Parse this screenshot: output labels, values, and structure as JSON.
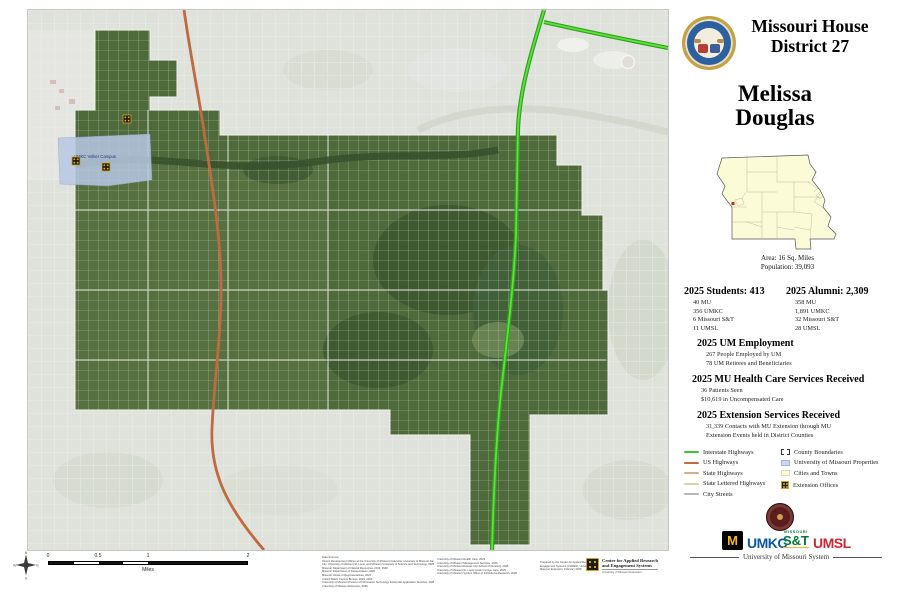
{
  "header": {
    "title_line1": "Missouri House",
    "title_line2": "District 27",
    "name_line1": "Melissa",
    "name_line2": "Douglas"
  },
  "inset": {
    "area": "Area: 16 Sq. Miles",
    "population": "Population: 39,093"
  },
  "stats": {
    "students": {
      "header": "2025 Students: 413",
      "items": [
        "40 MU",
        "356 UMKC",
        "6 Missouri S&T",
        "11 UMSL"
      ]
    },
    "alumni": {
      "header": "2025 Alumni: 2,309",
      "items": [
        "358 MU",
        "1,891 UMKC",
        "32 Missouri S&T",
        "28 UMSL"
      ]
    },
    "employment": {
      "header": "2025 UM Employment",
      "items": [
        "267 People Employed by UM",
        "78 UM Retirees and Beneficiaries"
      ]
    },
    "health": {
      "header": "2025 MU Health Care Services Received",
      "items": [
        "36 Patients Seen",
        "$10,619 in Uncompensated Care"
      ]
    },
    "extension": {
      "header": "2025 Extension Services Received",
      "items": [
        "31,339 Contacts with MU Extension through MU",
        "Extension Events held in District Counties"
      ]
    }
  },
  "legend": {
    "lines": [
      {
        "label": "Interstate Highways",
        "color": "#44c32c"
      },
      {
        "label": "US Highways",
        "color": "#bf6a40"
      },
      {
        "label": "State Highways",
        "color": "#cfb08d"
      },
      {
        "label": "State Lettered Highways",
        "color": "#dcd2a0"
      },
      {
        "label": "City Streets",
        "color": "#b5b5b5"
      }
    ],
    "areas": [
      {
        "label": "County Boundaries",
        "style": "dashed-outline"
      },
      {
        "label": "University of Missouri Properties",
        "color": "#ccd9ec"
      },
      {
        "label": "Cities and Towns",
        "color": "#fbfbdc"
      },
      {
        "label": "Extension Offices",
        "style": "gold-icon",
        "color": "#d9a821"
      }
    ]
  },
  "map": {
    "campus_label": "UMKC Volker Campus",
    "district_color": "#4e693a"
  },
  "scalebar": {
    "ticks": [
      "0",
      "0.5",
      "1",
      "2"
    ],
    "unit": "Miles"
  },
  "compass": {
    "n": "N",
    "e": "E",
    "s": "S",
    "w": "W"
  },
  "sources": {
    "col1": [
      "Data Sources:",
      "Alumni Development Offices at the University of Missouri-Columbia, University of Missouri-Kansas",
      "City, University of Missouri-St. Louis, and Missouri University of Science and Technology, 2025",
      "Missouri Department of Natural Resources, 2019, 2020",
      "Missouri Department of Transportation, 2024",
      "Missouri House of Representatives, 2024",
      "United States Census Bureau, 2023, 2024",
      "University of Missouri Division of Information Technology Enterprise Application Services, 2025",
      "University of Missouri Extension, 2025"
    ],
    "col2": [
      "University of Missouri Health Care, 2025",
      "University of Missouri Management Services, 2025",
      "University of Missouri-Kansas City School of Dentistry, 2025",
      "University of Missouri-St. Louis Center for Eye Care, 2025",
      "University of Missouri System Office of Institutional Research, 2025"
    ],
    "col3": [
      "Prepared by the Center for Applied Research and",
      "Engagement Systems (CARES), University of",
      "Missouri Extension, February 2025"
    ]
  },
  "cares": {
    "line1": "Center for Applied Research",
    "line2": "and Engagement Systems",
    "sub": "University of Missouri Extension"
  },
  "footer": {
    "system_label": "University of Missouri System",
    "mu": "M",
    "umkc": "UMKC",
    "sandt_top": "MISSOURI",
    "sandt": "S&T",
    "umsl": "UMSL"
  }
}
